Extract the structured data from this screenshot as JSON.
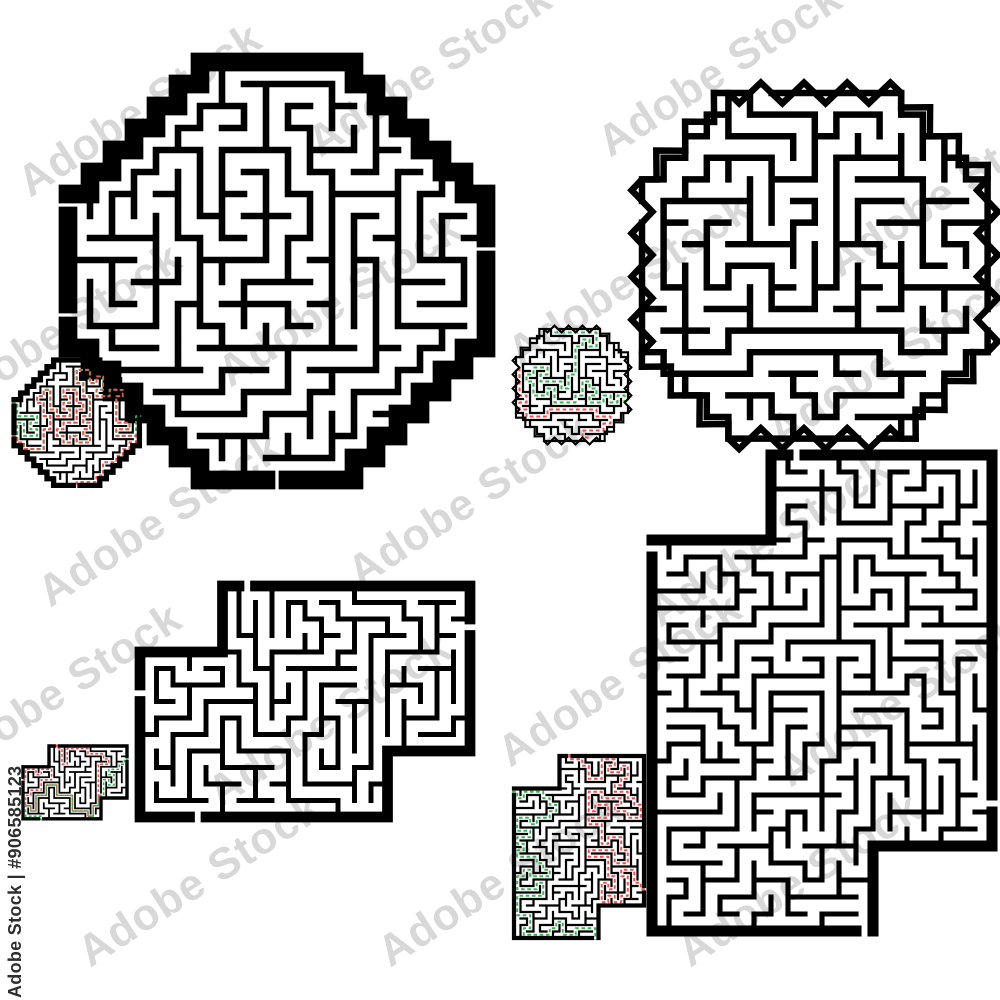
{
  "watermark": {
    "bar_text": "Adobe Stock | #906585123",
    "brand": "Adobe Stock",
    "stock_id": "#906585123",
    "tile_text": "Adobe Stock",
    "bar_color": "#2e2e2e",
    "tile_color": "#808080"
  },
  "colors": {
    "wall": "#000000",
    "background": "#ffffff",
    "solution_green": "#3cb254",
    "solution_red": "#ea5350"
  },
  "mazes": [
    {
      "name": "diamond-puzzle",
      "role": "puzzle",
      "shape": "diamond",
      "left": 68,
      "top": 62,
      "cols": 19,
      "rows": 19,
      "cell": 22,
      "seed": 11,
      "diamond_sum": 12,
      "border_ratio": 0.85,
      "wall_ratio": 0.3,
      "show_paths": false,
      "paths": [
        {
          "color": "green",
          "from": [
            0,
            6,
            "W"
          ],
          "to": [
            18,
            8,
            "E"
          ]
        },
        {
          "color": "red",
          "from": [
            0,
            11,
            "W"
          ],
          "to": [
            9,
            18,
            "S"
          ]
        }
      ]
    },
    {
      "name": "diamond-solution",
      "role": "solution",
      "shape": "diamond",
      "left": 14,
      "top": 360,
      "cols": 19,
      "rows": 19,
      "cell": 6.6,
      "seed": 11,
      "diamond_sum": 12,
      "border_ratio": 0.8,
      "wall_ratio": 0.32,
      "show_paths": true,
      "paths": [
        {
          "color": "green",
          "from": [
            0,
            6,
            "W"
          ],
          "to": [
            18,
            8,
            "E"
          ]
        },
        {
          "color": "red",
          "from": [
            0,
            11,
            "W"
          ],
          "to": [
            9,
            18,
            "S"
          ]
        }
      ]
    },
    {
      "name": "zigzag-octagon-puzzle",
      "role": "puzzle",
      "shape": "octagon",
      "left": 642,
      "top": 93,
      "cols": 16,
      "rows": 16,
      "cell": 21.6,
      "seed": 22,
      "corner_cut": 4,
      "zigzag_amp": 0.48,
      "zigzag_period": 1.0,
      "border_ratio": 0.3,
      "wall_ratio": 0.3,
      "show_paths": false,
      "paths": [
        {
          "color": "green",
          "from": [
            5,
            0,
            "N"
          ],
          "to": [
            15,
            10,
            "E"
          ]
        },
        {
          "color": "red",
          "from": [
            0,
            5,
            "W"
          ],
          "to": [
            10,
            15,
            "S"
          ]
        }
      ]
    },
    {
      "name": "zigzag-octagon-solution",
      "role": "solution",
      "shape": "octagon",
      "left": 516,
      "top": 329,
      "cols": 16,
      "rows": 16,
      "cell": 7,
      "seed": 22,
      "corner_cut": 4,
      "zigzag_amp": 0.48,
      "zigzag_period": 1.0,
      "border_ratio": 0.3,
      "wall_ratio": 0.32,
      "show_paths": true,
      "paths": [
        {
          "color": "green",
          "from": [
            5,
            0,
            "N"
          ],
          "to": [
            15,
            10,
            "E"
          ]
        },
        {
          "color": "red",
          "from": [
            0,
            5,
            "W"
          ],
          "to": [
            10,
            15,
            "S"
          ]
        }
      ]
    },
    {
      "name": "notched-rect-puzzle",
      "role": "puzzle",
      "shape": "union",
      "left": 140,
      "top": 586,
      "cols": 20,
      "rows": 14,
      "cell": 16.5,
      "seed": 33,
      "rects": [
        [
          5,
          0,
          19,
          9
        ],
        [
          0,
          4,
          14,
          13
        ]
      ],
      "border_ratio": 0.65,
      "wall_ratio": 0.3,
      "show_paths": false,
      "paths": [
        {
          "color": "red",
          "from": [
            6,
            0,
            "N"
          ],
          "to": [
            0,
            6,
            "W"
          ]
        },
        {
          "color": "green",
          "from": [
            19,
            2,
            "E"
          ],
          "to": [
            3,
            13,
            "S"
          ]
        }
      ]
    },
    {
      "name": "notched-rect-solution",
      "role": "solution",
      "shape": "union",
      "left": 23,
      "top": 746,
      "cols": 20,
      "rows": 14,
      "cell": 5.2,
      "seed": 33,
      "rects": [
        [
          5,
          0,
          19,
          9
        ],
        [
          0,
          4,
          14,
          13
        ]
      ],
      "border_ratio": 0.65,
      "wall_ratio": 0.34,
      "show_paths": true,
      "paths": [
        {
          "color": "red",
          "from": [
            6,
            0,
            "N"
          ],
          "to": [
            0,
            6,
            "W"
          ]
        },
        {
          "color": "green",
          "from": [
            19,
            2,
            "E"
          ],
          "to": [
            3,
            13,
            "S"
          ]
        }
      ]
    },
    {
      "name": "tall-notched-rect-puzzle",
      "role": "puzzle",
      "shape": "union",
      "left": 652,
      "top": 455,
      "cols": 20,
      "rows": 28,
      "cell": 17,
      "seed": 44,
      "rects": [
        [
          7,
          0,
          19,
          22
        ],
        [
          0,
          5,
          12,
          27
        ]
      ],
      "border_ratio": 0.65,
      "wall_ratio": 0.3,
      "show_paths": false,
      "paths": [
        {
          "color": "red",
          "from": [
            8,
            0,
            "N"
          ],
          "to": [
            19,
            20,
            "E"
          ]
        },
        {
          "color": "green",
          "from": [
            0,
            5,
            "W"
          ],
          "to": [
            12,
            27,
            "S"
          ]
        }
      ]
    },
    {
      "name": "tall-notched-rect-solution",
      "role": "solution",
      "shape": "union",
      "left": 514,
      "top": 756,
      "cols": 20,
      "rows": 28,
      "cell": 6.5,
      "seed": 44,
      "rects": [
        [
          7,
          0,
          19,
          22
        ],
        [
          0,
          5,
          12,
          27
        ]
      ],
      "border_ratio": 0.65,
      "wall_ratio": 0.34,
      "show_paths": true,
      "paths": [
        {
          "color": "red",
          "from": [
            8,
            0,
            "N"
          ],
          "to": [
            19,
            20,
            "E"
          ]
        },
        {
          "color": "green",
          "from": [
            0,
            5,
            "W"
          ],
          "to": [
            12,
            27,
            "S"
          ]
        }
      ]
    }
  ]
}
